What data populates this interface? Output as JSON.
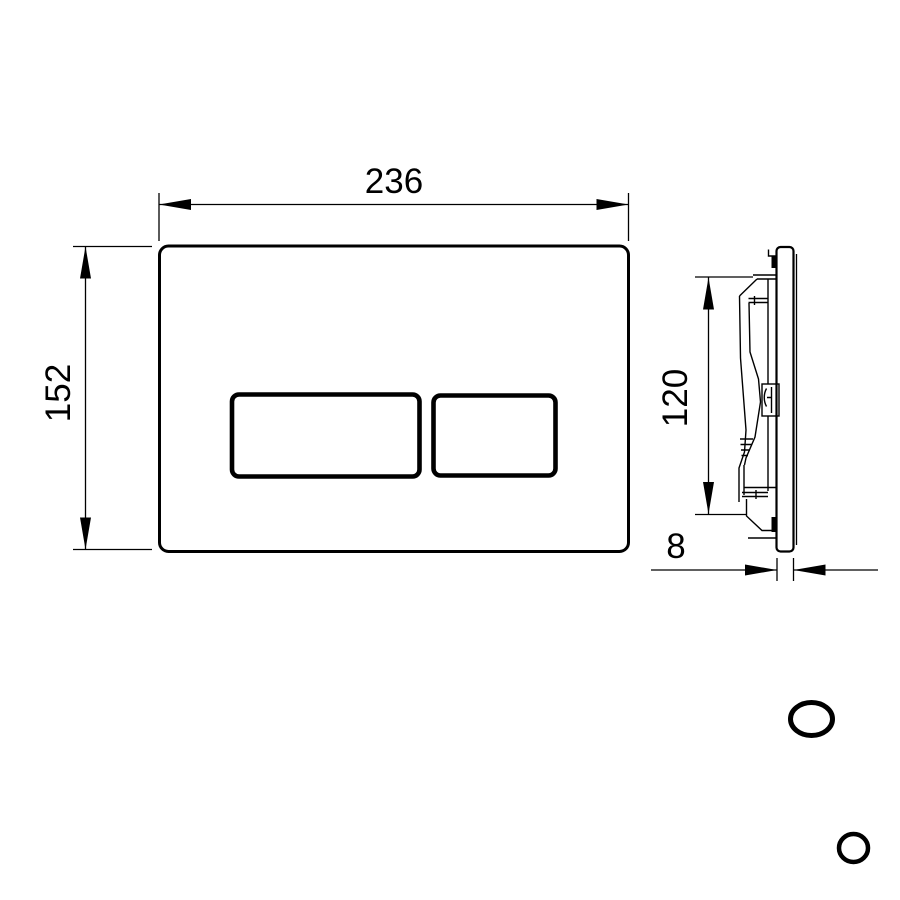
{
  "drawing": {
    "type": "technical-dimension-drawing",
    "subject": "wall-mounted flush plate with two rectangular buttons, front and side views",
    "background_color": "#ffffff",
    "line_color": "#000000",
    "dimensions": {
      "plate_width": "236",
      "plate_height": "152",
      "mechanism_height": "120",
      "plate_thickness": "8"
    }
  }
}
